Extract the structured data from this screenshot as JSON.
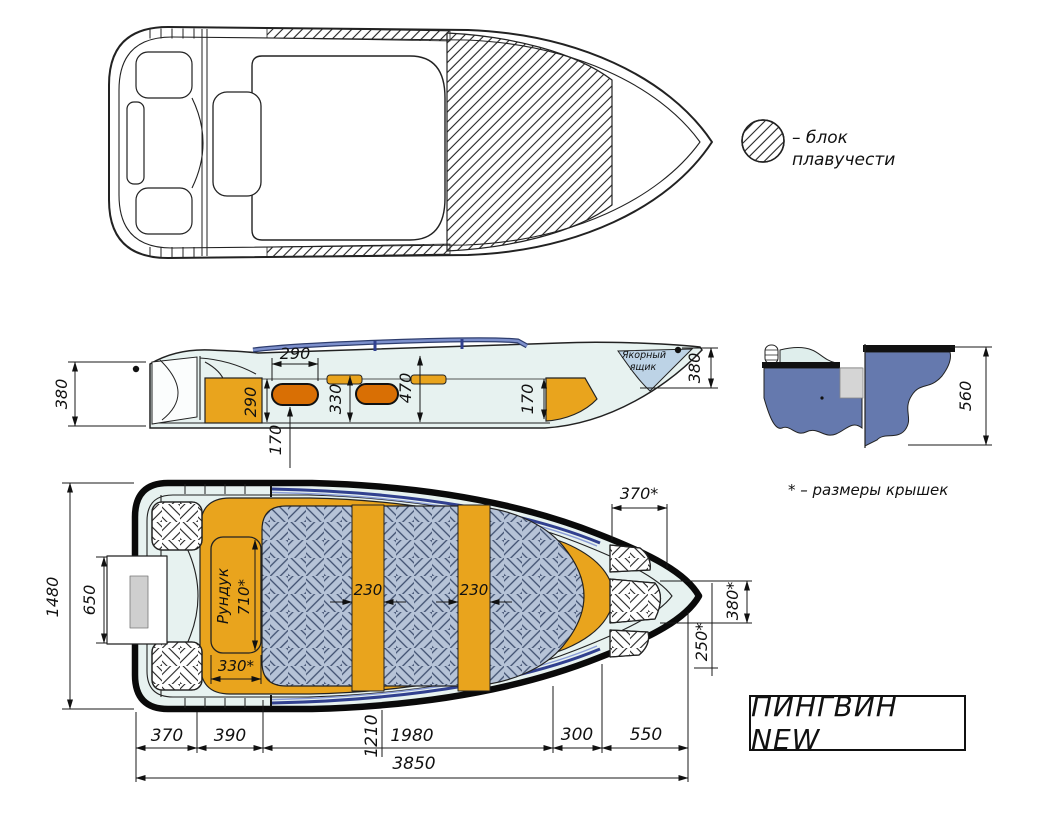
{
  "title_block": {
    "label": "ПИНГВИН NEW"
  },
  "legend": {
    "line1": "– блок",
    "line2": "плавучести"
  },
  "footnote": "* – размеры крышек",
  "side_view": {
    "dim_transom_height": "380",
    "dim_stern_box_height": "290",
    "dim_seat_width": "290",
    "dim_seat_to_floor": "170",
    "dim_mid_locker_height": "330",
    "dim_cockpit_depth": "470",
    "dim_bow_locker_height": "170",
    "dim_bow_height": "380",
    "anchor_box_line1": "Якорный",
    "anchor_box_line2": "ящик"
  },
  "section_view": {
    "dim_height": "560"
  },
  "plan_view": {
    "dim_beam": "1480",
    "dim_transom_cutout": "650",
    "dim_bow_hatch_width": "370*",
    "dim_bow_hatch_height": "380*",
    "dim_bow_hatch_length": "250*",
    "dim_bench1_width": "230",
    "dim_bench2_width": "230",
    "locker_label": "Рундук",
    "dim_locker_length": "710*",
    "dim_locker_width": "330*"
  },
  "length_chain": {
    "d370": "370",
    "d390": "390",
    "d1210": "1210",
    "d1980": "1980",
    "d300": "300",
    "d550": "550",
    "total": "3850"
  },
  "colors": {
    "amber": "#E9A41D",
    "seat_orange": "#D96F04",
    "hull_cyan": "#E7F2F0",
    "checker_blue": "#B6C3D7",
    "section_blue": "#6579AE",
    "rail_blue": "#31408F"
  }
}
